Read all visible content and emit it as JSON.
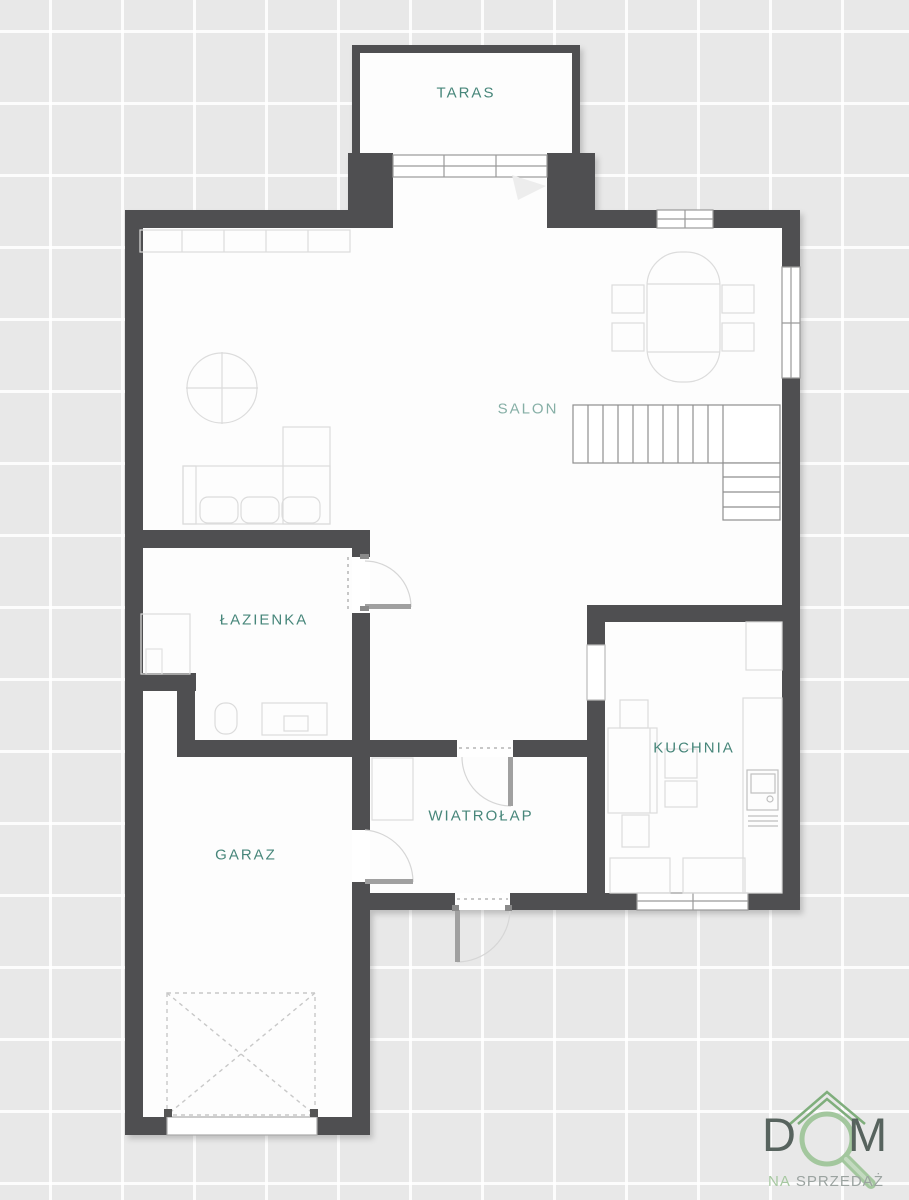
{
  "plan": {
    "rooms": [
      {
        "id": "taras",
        "label": "TARAS"
      },
      {
        "id": "salon",
        "label": "SALON"
      },
      {
        "id": "lazienka",
        "label": "ŁAZIENKA"
      },
      {
        "id": "kuchnia",
        "label": "KUCHNIA"
      },
      {
        "id": "wiatrolap",
        "label": "WIATROŁAP"
      },
      {
        "id": "garaz",
        "label": "GARAZ"
      }
    ],
    "colors": {
      "background": "#e8e8e8",
      "grid_line": "#ffffff",
      "wall": "#4f4f51",
      "floor": "#fdfdfd",
      "label": "#47867a",
      "salon_label": "#86afa6",
      "furniture_line": "#dcdcdc",
      "stairs_line": "#8f8f8f",
      "door_leaf": "#a0a0a0"
    }
  },
  "logo": {
    "word_start": "D",
    "word_end": "M",
    "tagline_na": "NA",
    "tagline_rest": "SPRZEDAŻ",
    "colors": {
      "roof_green": "#7fae7c",
      "magnifier_green": "#a3c79e",
      "letters": "#57635e",
      "tagline_gray": "#9ba3a0"
    }
  }
}
